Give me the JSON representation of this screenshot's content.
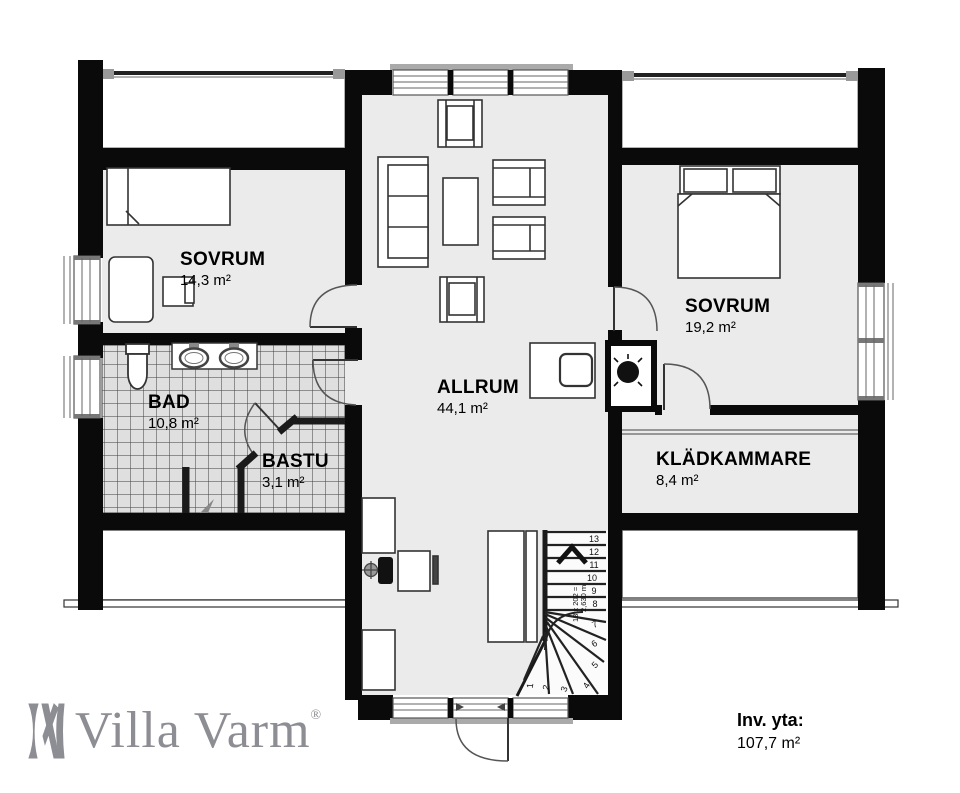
{
  "plan": {
    "rooms": [
      {
        "id": "sovrum1",
        "name": "SOVRUM",
        "area": "14,3 m²"
      },
      {
        "id": "sovrum2",
        "name": "SOVRUM",
        "area": "19,2 m²"
      },
      {
        "id": "allrum",
        "name": "ALLRUM",
        "area": "44,1 m²"
      },
      {
        "id": "bad",
        "name": "BAD",
        "area": "10,8 m²"
      },
      {
        "id": "bastu",
        "name": "BASTU",
        "area": "3,1 m²"
      },
      {
        "id": "kladkammare",
        "name": "KLÄDKAMMARE",
        "area": "8,4 m²"
      }
    ],
    "stairs": {
      "step_numbers": [
        "1",
        "2",
        "3",
        "4",
        "5",
        "6",
        "7",
        "8",
        "9",
        "10",
        "11",
        "12",
        "13"
      ],
      "annotation_line1": "13 x 202 =",
      "annotation_line2": "2,630 m"
    },
    "footer": {
      "brand": "Villa Varm",
      "brand_reg": "®",
      "area_label": "Inv. yta:",
      "area_value": "107,7 m²"
    },
    "colors": {
      "wall": "#0a0a0a",
      "floor": "#ebebeb",
      "tile_floor": "#dfdfdf",
      "tile_line": "#3d3d3d",
      "line": "#333333",
      "logo": "#8d8d94"
    }
  }
}
